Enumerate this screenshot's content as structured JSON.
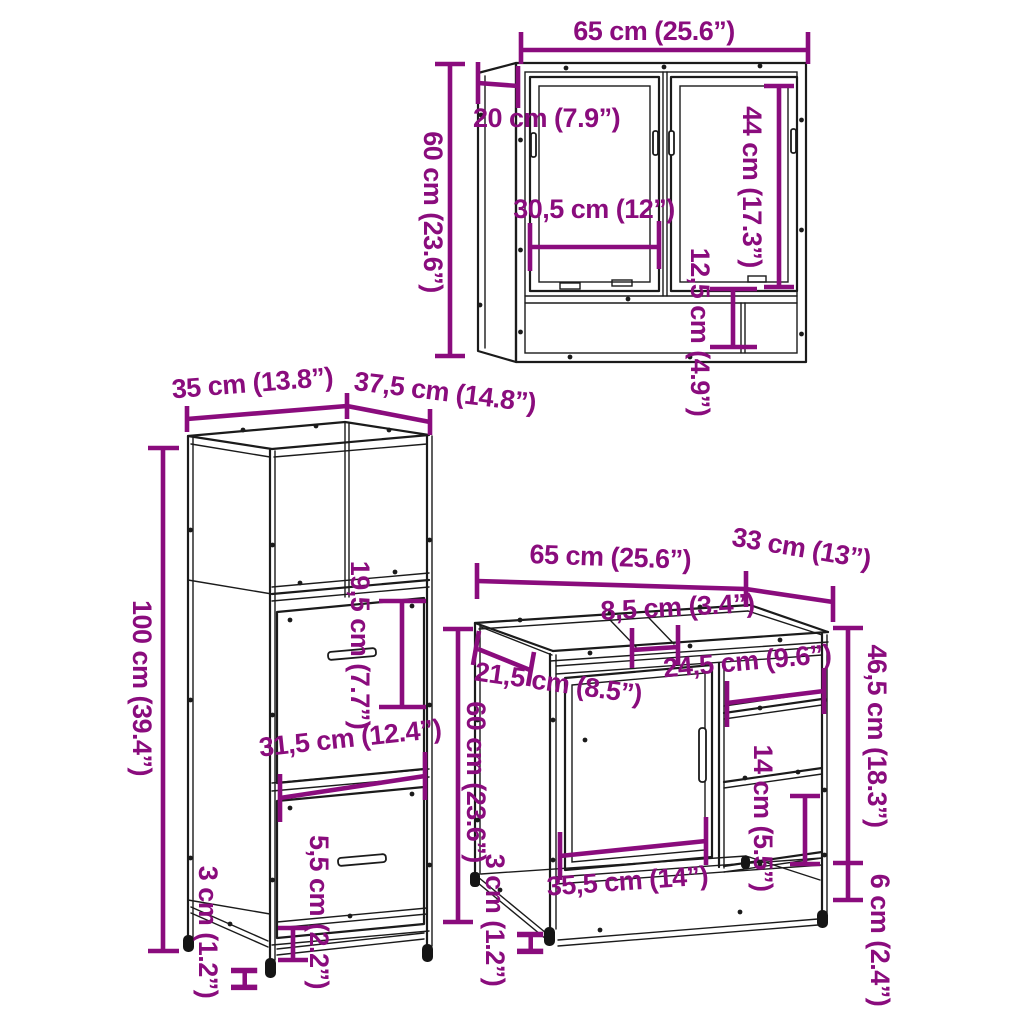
{
  "diagram": {
    "background": "#ffffff",
    "dimension_color": "#8A0C7D",
    "line_color": "#1b1b1b",
    "foot_marker": "H"
  },
  "mirror_cabinet": {
    "width": "65 cm (25.6”)",
    "depth": "20 cm (7.9”)",
    "height": "60 cm (23.6”)",
    "door_height": "44 cm (17.3”)",
    "door_width": "30,5 cm (12”)",
    "shelf_height": "12,5 cm (4.9”)"
  },
  "tall_cabinet": {
    "width": "35 cm (13.8”)",
    "depth": "37,5 cm (14.8”)",
    "height": "100 cm (39.4”)",
    "opening_height": "19,5 cm (7.7”)",
    "drawer_width": "31,5 cm (12.4”)",
    "plinth_height": "5,5 cm (2.2”)",
    "foot_height": "3 cm (1.2”)"
  },
  "sink_cabinet": {
    "width": "65 cm (25.6”)",
    "depth": "33 cm (13”)",
    "top_rail_width": "8,5 cm (3.4”)",
    "left_depth": "21,5 cm (8.5”)",
    "shelf_width": "24,5 cm (9.6”)",
    "height": "60 cm (23.6”)",
    "side_height": "46,5 cm (18.3”)",
    "shelf_gap": "14 cm (5.5”)",
    "door_width": "35,5 cm (14”)",
    "bottom_clearance": "6 cm (2.4”)",
    "foot_height": "3 cm (1.2”)"
  }
}
